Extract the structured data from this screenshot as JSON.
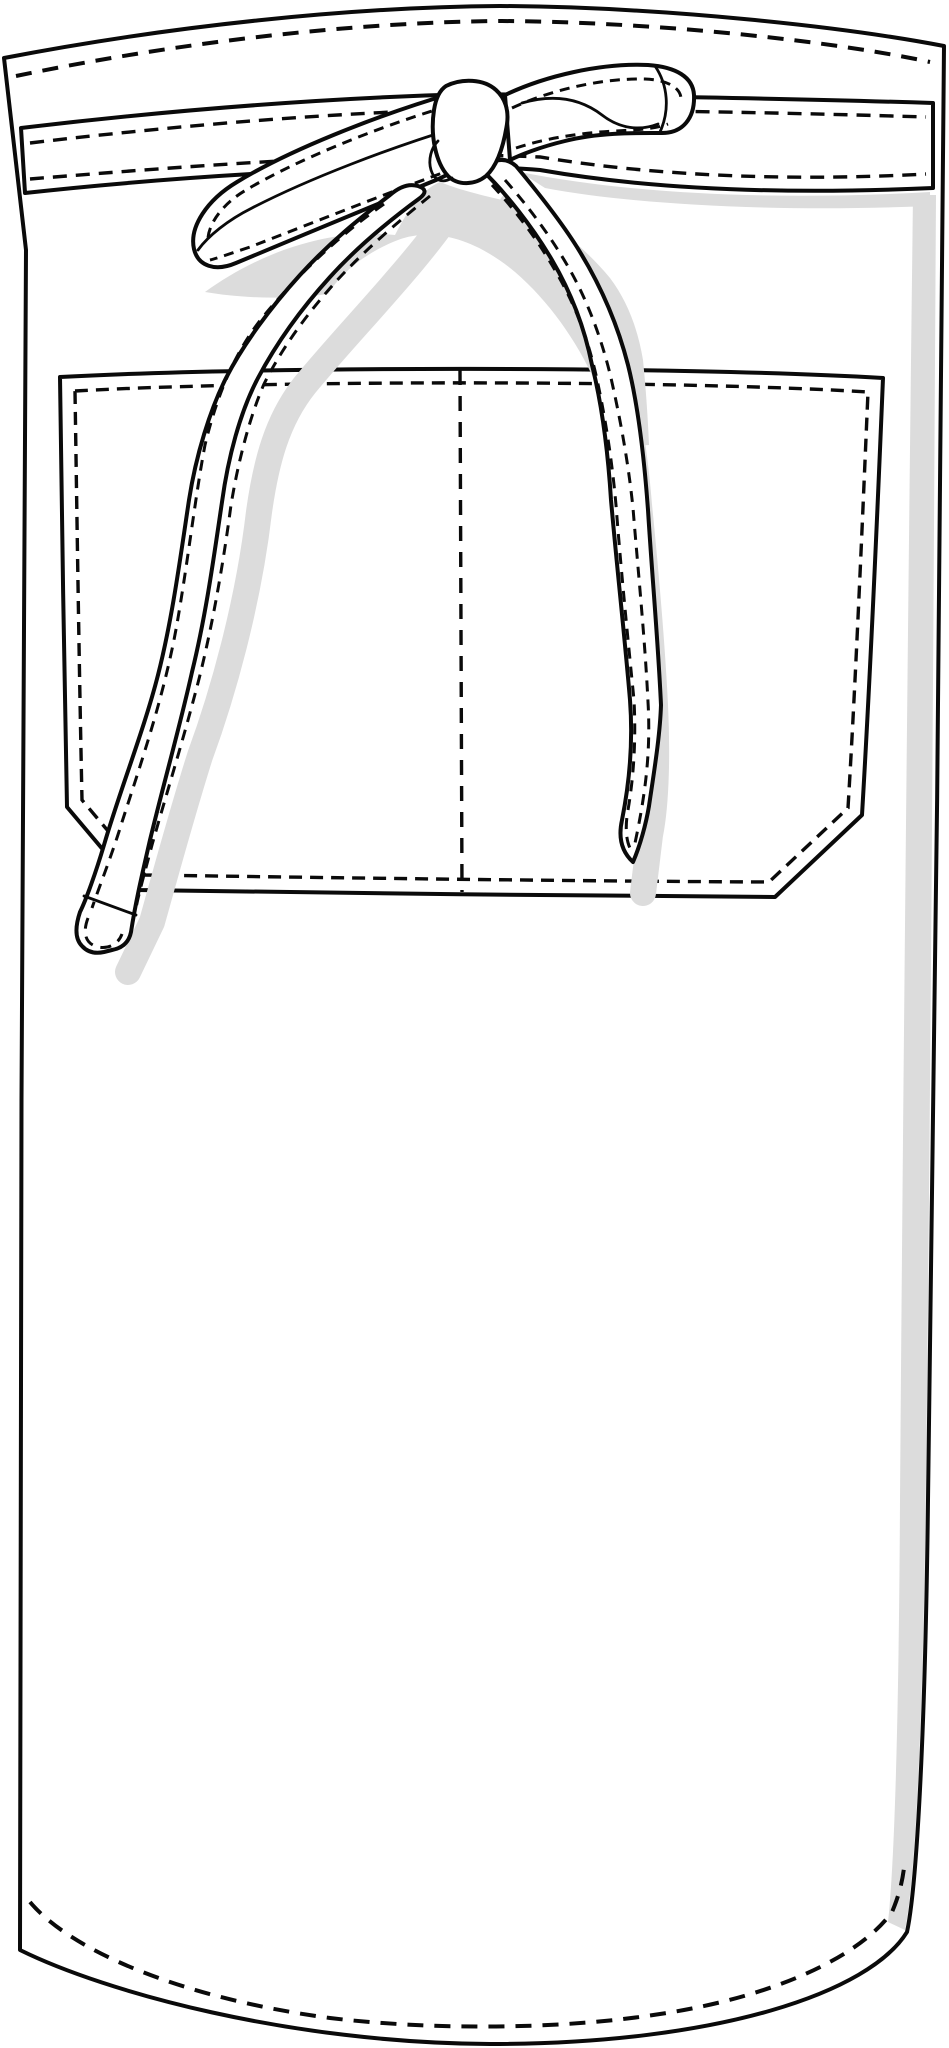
{
  "illustration": {
    "description": "Technical flat line drawing of a bistro waist apron: waistband tied in a front bow with two hanging straps, and a wide double-compartment front pocket with dashed stitching",
    "parts": {
      "apron_body": "apron body panel",
      "waistband": "waist tie band",
      "bow": "front bow knot",
      "left_loop": "bow loop left",
      "right_loop": "bow loop right",
      "left_strap": "hanging tie strap left",
      "right_strap": "hanging tie strap right",
      "pocket": "front patch pocket",
      "pocket_divider": "pocket divider stitch"
    }
  },
  "colors": {
    "paper": "#ffffff",
    "ink": "#0a0a0a",
    "shadow": "#dcdcdc"
  }
}
